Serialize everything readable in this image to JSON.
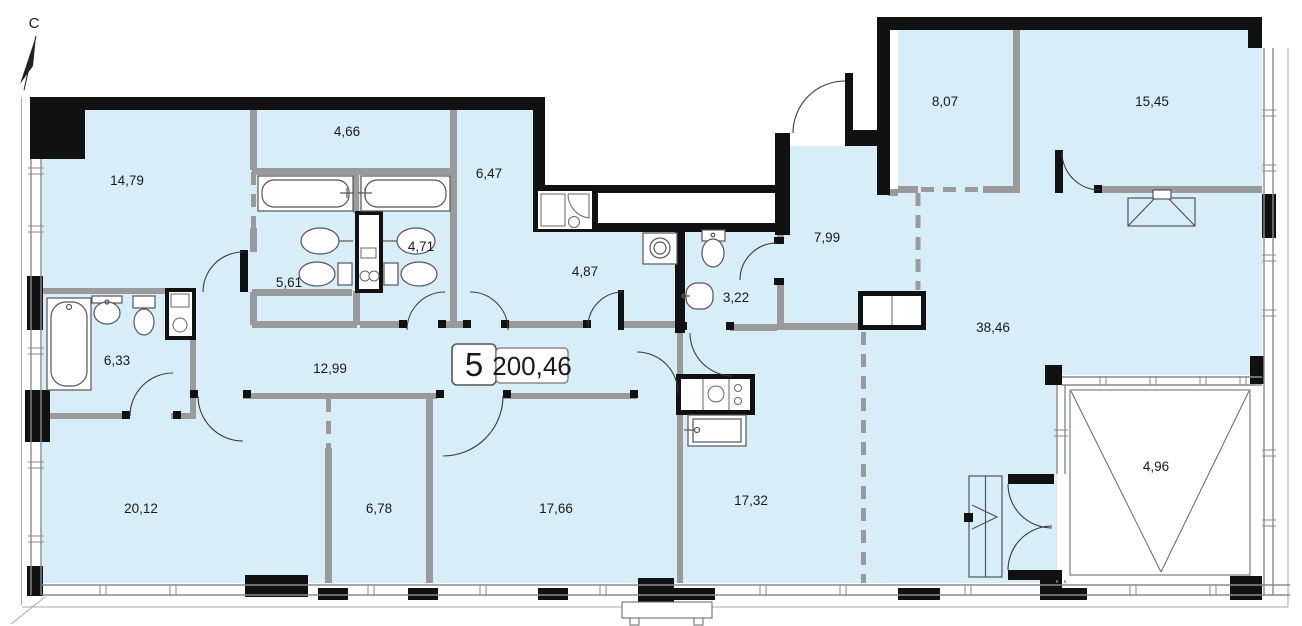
{
  "colors": {
    "floor": "#d7eef9",
    "wall": "#111111",
    "partition": "#9a9a9a",
    "door_line": "#3a3a3a",
    "fixture_line": "#555555"
  },
  "north_indicator": {
    "label": "С"
  },
  "apartment_label": {
    "number": "5",
    "total_area": "200,46"
  },
  "rooms": [
    {
      "name": "room-top-left",
      "area": "14,79"
    },
    {
      "name": "wardrobe-top",
      "area": "4,66"
    },
    {
      "name": "hall-upper",
      "area": "6,47"
    },
    {
      "name": "bathroom-right",
      "area": "4,71"
    },
    {
      "name": "bathroom-left",
      "area": "5,61"
    },
    {
      "name": "laundry",
      "area": "4,87"
    },
    {
      "name": "wc",
      "area": "3,22"
    },
    {
      "name": "entry-hall",
      "area": "7,99"
    },
    {
      "name": "room-top-right-small",
      "area": "8,07"
    },
    {
      "name": "room-top-right-large",
      "area": "15,45"
    },
    {
      "name": "kitchen-living",
      "area": "38,46"
    },
    {
      "name": "bathroom-west",
      "area": "6,33"
    },
    {
      "name": "corridor",
      "area": "12,99"
    },
    {
      "name": "room-bottom-left",
      "area": "20,12"
    },
    {
      "name": "room-bottom-small",
      "area": "6,78"
    },
    {
      "name": "room-bottom-mid",
      "area": "17,66"
    },
    {
      "name": "room-bottom-right",
      "area": "17,32"
    },
    {
      "name": "balcony",
      "area": "4,96"
    }
  ]
}
